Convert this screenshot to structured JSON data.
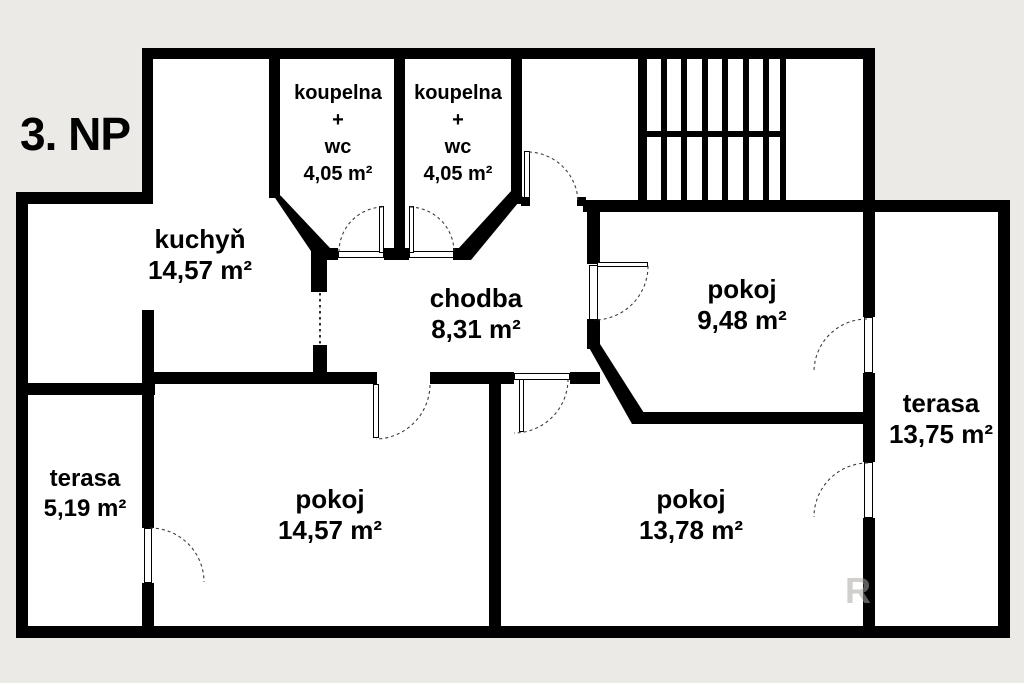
{
  "title": "3. NP",
  "watermark": "R",
  "colors": {
    "background": "#eceae7",
    "interior": "#ffffff",
    "wall": "#000000",
    "door_arc": "#3c3c3c",
    "watermark": "#c9c6c2"
  },
  "rooms": {
    "koupelna1": {
      "name": "koupelna",
      "plus": "+",
      "type": "wc",
      "area": "4,05 m²"
    },
    "koupelna2": {
      "name": "koupelna",
      "plus": "+",
      "type": "wc",
      "area": "4,05 m²"
    },
    "kuchyn": {
      "name": "kuchyň",
      "area": "14,57 m²"
    },
    "chodba": {
      "name": "chodba",
      "area": "8,31 m²"
    },
    "pokoj_horni": {
      "name": "pokoj",
      "area": "9,48 m²"
    },
    "terasa_prava": {
      "name": "terasa",
      "area": "13,75 m²"
    },
    "terasa_leva": {
      "name": "terasa",
      "area": "5,19 m²"
    },
    "pokoj_levy": {
      "name": "pokoj",
      "area": "14,57 m²"
    },
    "pokoj_pravy": {
      "name": "pokoj",
      "area": "13,78 m²"
    }
  }
}
